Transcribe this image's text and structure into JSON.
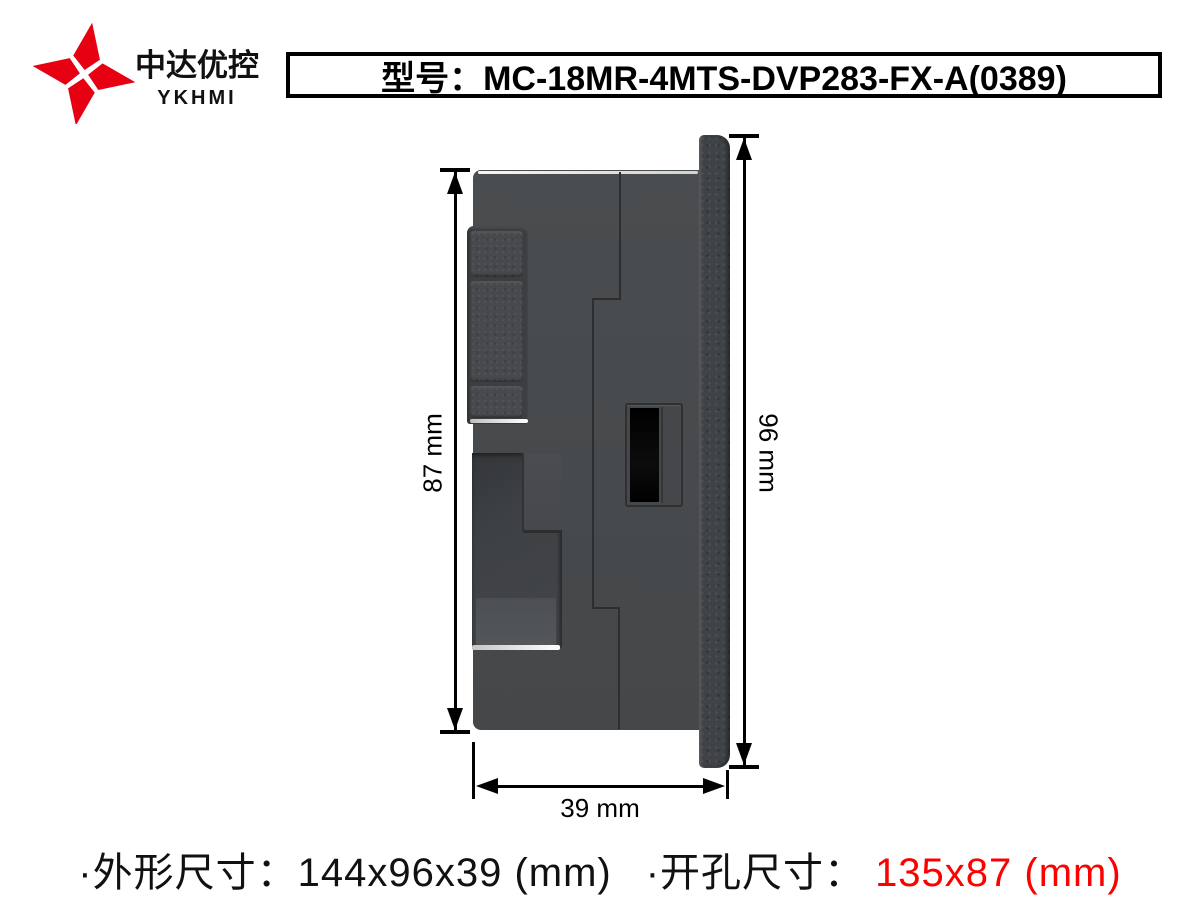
{
  "brand": {
    "name_cn": "中达优控",
    "name_en": "YKHMI",
    "logo_icon": "four-diamond-pinwheel",
    "logo_color": "#e60012"
  },
  "model_box": {
    "text": "型号：MC-18MR-4MTS-DVP283-FX-A(0389)"
  },
  "drawing": {
    "view": "device-side-view",
    "dim_left": "87 mm",
    "dim_right": "96 mm",
    "dim_bottom": "39 mm",
    "body_color": "#474a4c",
    "bezel_color": "#3f4246",
    "port_color": "#000000"
  },
  "footer": {
    "outline_text": "·外形尺寸：144x96x39 (mm)",
    "cutout_label": "·开孔尺寸：",
    "cutout_value": "135x87 (mm)",
    "cutout_value_color": "#fe0000"
  }
}
